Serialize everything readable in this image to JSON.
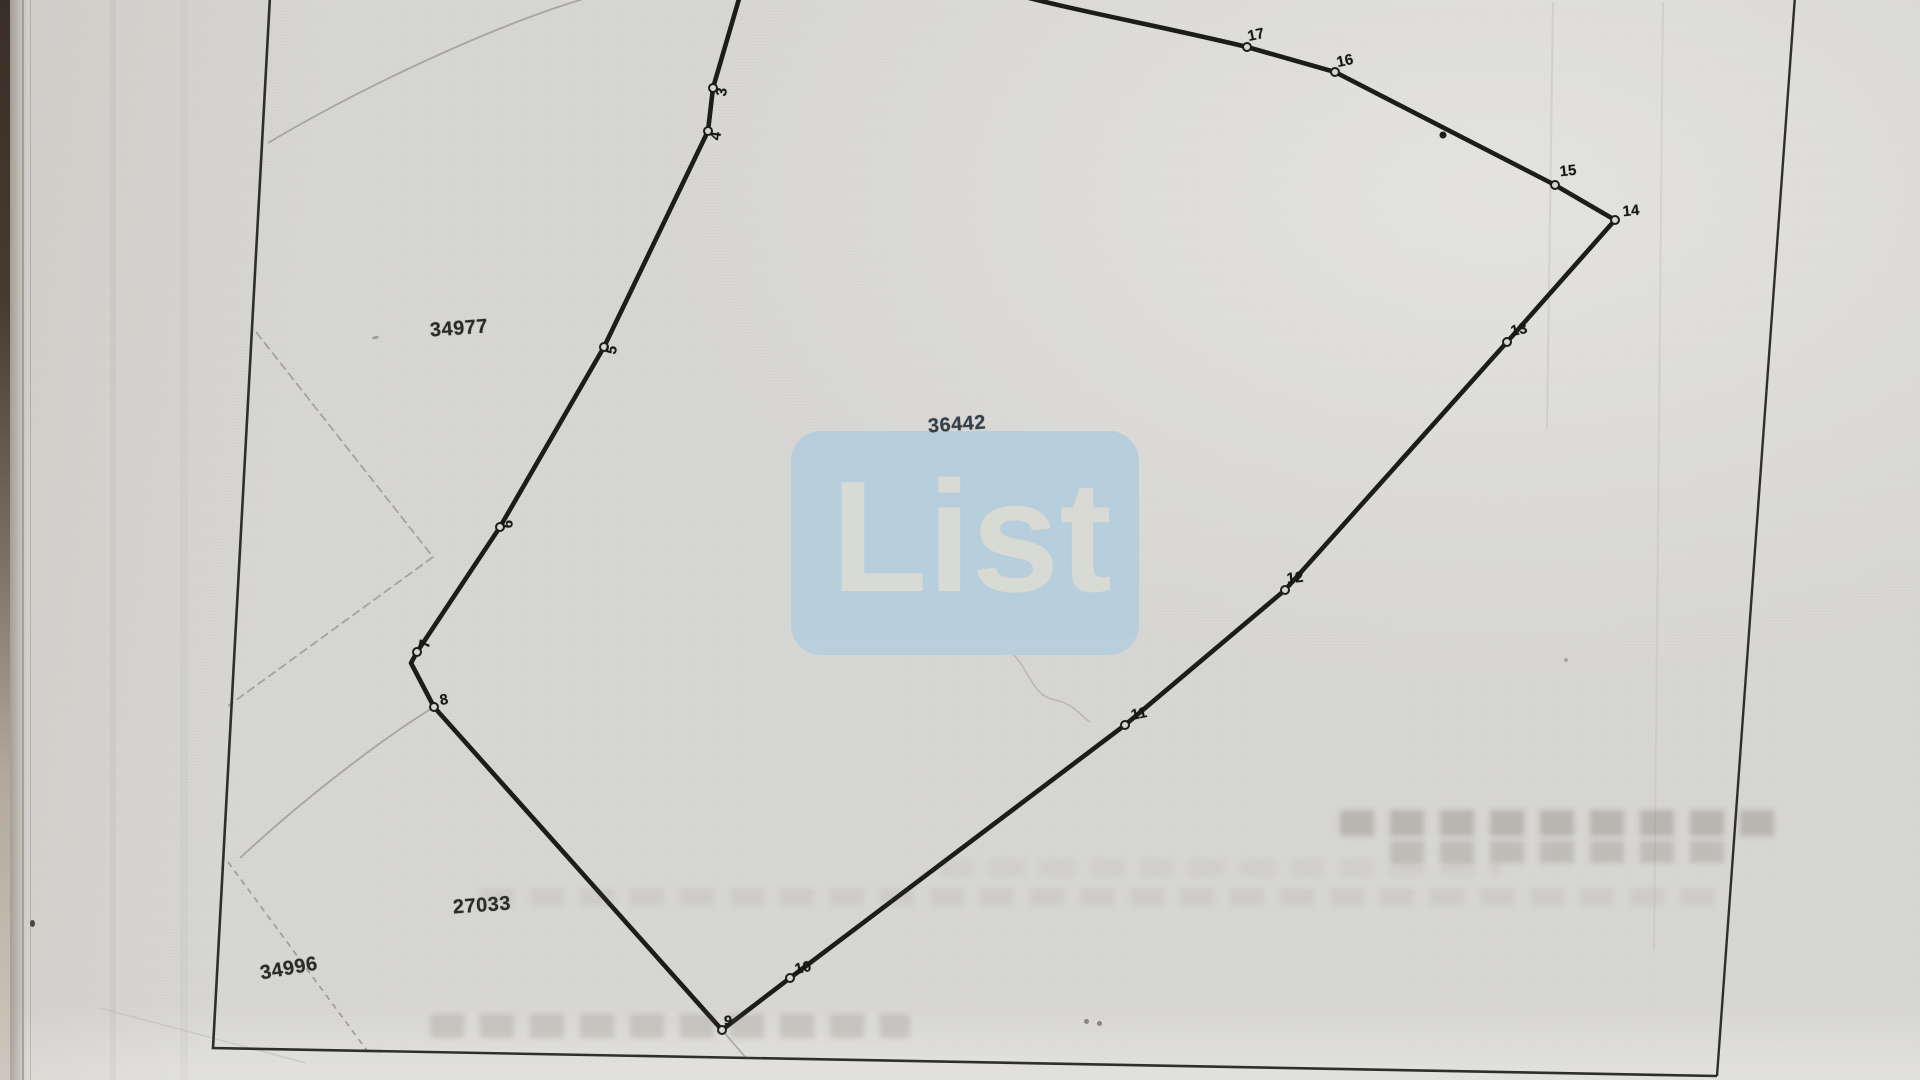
{
  "map": {
    "parcel_labels": [
      {
        "id": "34977"
      },
      {
        "id": "36442"
      },
      {
        "id": "27033"
      },
      {
        "id": "34996"
      }
    ],
    "boundary_points": [
      {
        "label": "3"
      },
      {
        "label": "4"
      },
      {
        "label": "5"
      },
      {
        "label": "6"
      },
      {
        "label": "7"
      },
      {
        "label": "8"
      },
      {
        "label": "9"
      },
      {
        "label": "10"
      },
      {
        "label": "11"
      },
      {
        "label": "12"
      },
      {
        "label": "13"
      },
      {
        "label": "14"
      },
      {
        "label": "15"
      },
      {
        "label": "16"
      },
      {
        "label": "17"
      }
    ]
  },
  "watermark": {
    "text": "List"
  },
  "colors": {
    "paper": "#d7d6d2",
    "boundary_line": "#1c1c1a",
    "frame_line": "#2e2e2b",
    "faint_line": "#9b9a94",
    "point_label": "#151514",
    "parcel_label": "#2a2a27",
    "parcel_label_accent": "#333f4c",
    "watermark_box": "#b6cedd",
    "watermark_text": "#d9dbd5"
  }
}
